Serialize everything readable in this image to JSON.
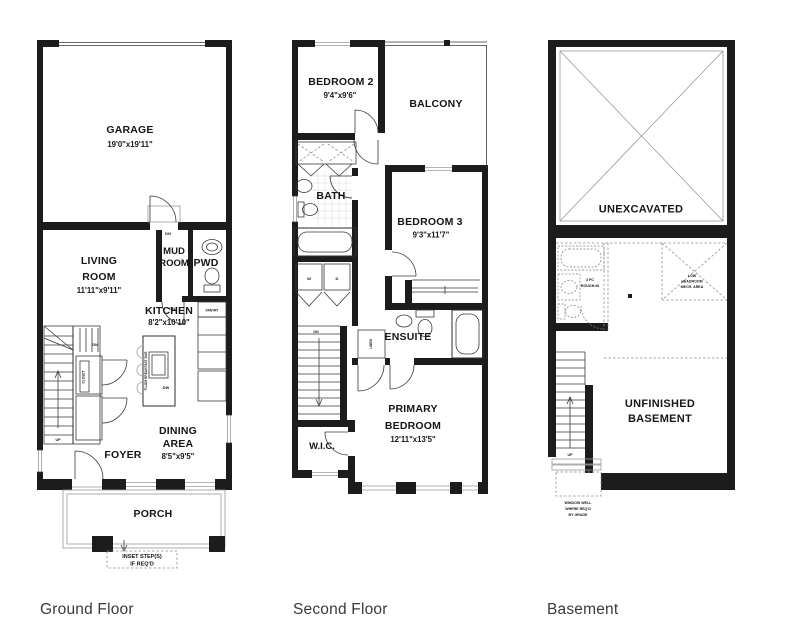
{
  "page": {
    "background": "#ffffff",
    "wall_color": "#1c1c1c",
    "title_color": "#3a3a3a"
  },
  "titles": {
    "ground": "Ground Floor",
    "second": "Second Floor",
    "basement": "Basement"
  },
  "ground": {
    "garage": {
      "name": "GARAGE",
      "dims": "19'0\"x19'11\""
    },
    "living": {
      "l1": "LIVING",
      "l2": "ROOM",
      "dims": "11'11\"x9'11\""
    },
    "mud": {
      "l1": "MUD",
      "l2": "ROOM"
    },
    "pwd": {
      "name": "PWD"
    },
    "kitchen": {
      "name": "KITCHEN",
      "dims": "8'2\"x10'10\""
    },
    "dining": {
      "l1": "DINING",
      "l2": "AREA",
      "dims": "8'5\"x9'5\""
    },
    "foyer": {
      "name": "FOYER"
    },
    "porch": {
      "name": "PORCH"
    },
    "pantry": "PANTRY",
    "closet": "CLOSET",
    "breakfast_bar": "FLUSH BREAKFAST BAR",
    "dw": "DW",
    "dn_garage": "DN",
    "dn_kitchen": "DN",
    "dn_stairs": "DN",
    "up_stairs": "UP",
    "inset_note": {
      "l1": "INSET STEP(S)",
      "l2": "IF REQ'D"
    }
  },
  "second": {
    "bedroom2": {
      "name": "BEDROOM 2",
      "dims": "9'4\"x9'6\""
    },
    "balcony": {
      "name": "BALCONY"
    },
    "bath": {
      "name": "BATH"
    },
    "bedroom3": {
      "name": "BEDROOM 3",
      "dims": "9'3\"x11'7\""
    },
    "ensuite": {
      "name": "ENSUITE"
    },
    "linen": "LINEN",
    "primary": {
      "l1": "PRIMARY",
      "l2": "BEDROOM",
      "dims": "12'11\"x13'5\""
    },
    "wic": {
      "name": "W.I.C."
    },
    "washer": "W",
    "dryer": "D",
    "dn_stairs": "DN"
  },
  "basement": {
    "unexcavated": "UNEXCAVATED",
    "unfinished": {
      "l1": "UNFINISHED",
      "l2": "BASEMENT"
    },
    "rough_in": {
      "l1": "3 PC",
      "l2": "ROUGH-IN"
    },
    "low_headroom": {
      "l1": "LOW",
      "l2": "HEADROOM",
      "l3": "MECH. AREA"
    },
    "up_stairs": "UP",
    "window_well": {
      "l1": "WINDOW WELL",
      "l2": "WHERE REQ'D",
      "l3": "BY GRADE"
    }
  }
}
